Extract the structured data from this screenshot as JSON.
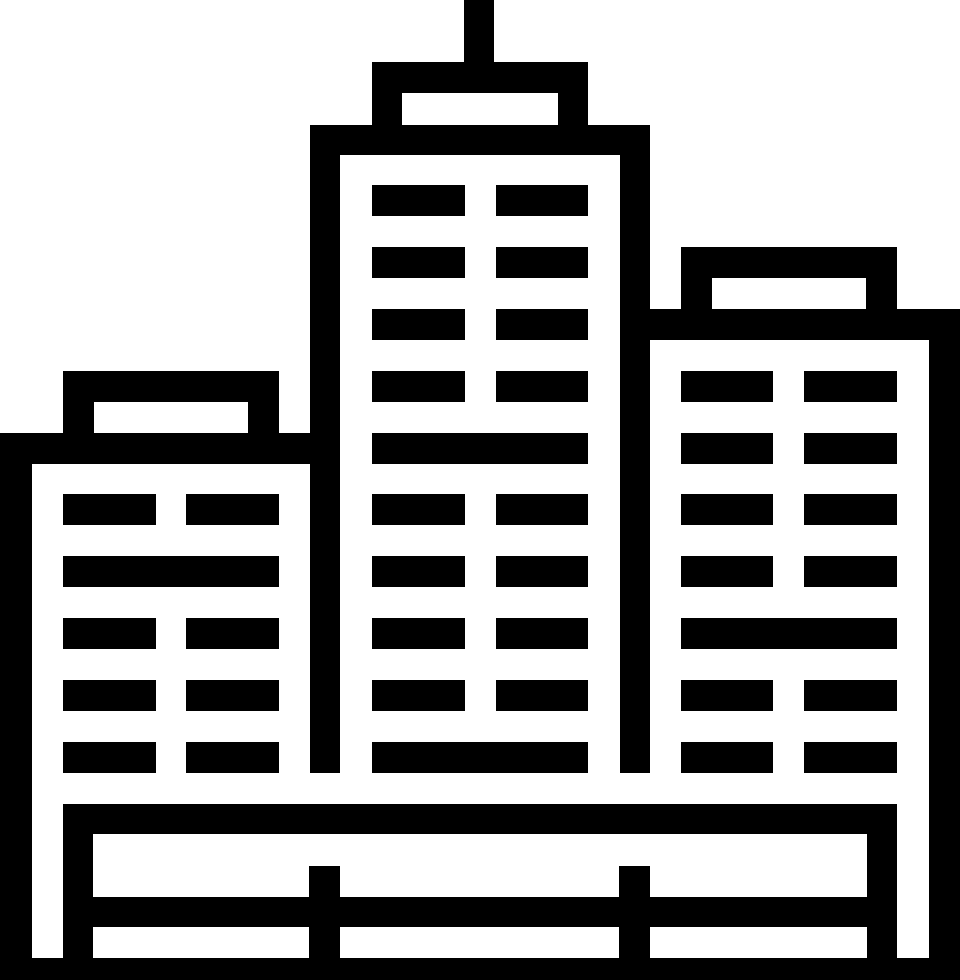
{
  "window": {
    "width": 960,
    "height": 980,
    "background": "#ffffff"
  },
  "icon": {
    "name": "city-buildings-icon",
    "label": "City buildings glyph icon: three skyscrapers with rooftop structures, an antenna, window grids and a fence base",
    "foreground": "#000000",
    "background": "#ffffff",
    "canvas": {
      "width": 960,
      "height": 980
    },
    "groups": [
      {
        "name": "center-building",
        "rects": [
          {
            "name": "antenna",
            "x": 464,
            "y": 0,
            "w": 30,
            "h": 62
          },
          {
            "name": "penthouse-roof",
            "x": 372,
            "y": 62,
            "w": 216,
            "h": 31
          },
          {
            "name": "penthouse-left-wall",
            "x": 372,
            "y": 93,
            "w": 30,
            "h": 32
          },
          {
            "name": "penthouse-right-wall",
            "x": 558,
            "y": 93,
            "w": 30,
            "h": 32
          },
          {
            "name": "top-bar",
            "x": 310,
            "y": 125,
            "w": 340,
            "h": 30
          },
          {
            "name": "left-wall",
            "x": 310,
            "y": 155,
            "w": 30,
            "h": 618
          },
          {
            "name": "right-wall",
            "x": 620,
            "y": 155,
            "w": 30,
            "h": 618
          },
          {
            "name": "window",
            "x": 372,
            "y": 185,
            "w": 93,
            "h": 31
          },
          {
            "name": "window",
            "x": 496,
            "y": 185,
            "w": 92,
            "h": 31
          },
          {
            "name": "window",
            "x": 372,
            "y": 247,
            "w": 93,
            "h": 31
          },
          {
            "name": "window",
            "x": 496,
            "y": 247,
            "w": 92,
            "h": 31
          },
          {
            "name": "window",
            "x": 372,
            "y": 309,
            "w": 93,
            "h": 31
          },
          {
            "name": "window",
            "x": 496,
            "y": 309,
            "w": 92,
            "h": 31
          },
          {
            "name": "window",
            "x": 372,
            "y": 371,
            "w": 93,
            "h": 31
          },
          {
            "name": "window",
            "x": 496,
            "y": 371,
            "w": 92,
            "h": 31
          },
          {
            "name": "window-band",
            "x": 372,
            "y": 433,
            "w": 216,
            "h": 31
          },
          {
            "name": "window",
            "x": 372,
            "y": 494,
            "w": 93,
            "h": 31
          },
          {
            "name": "window",
            "x": 496,
            "y": 494,
            "w": 92,
            "h": 31
          },
          {
            "name": "window",
            "x": 372,
            "y": 556,
            "w": 93,
            "h": 31
          },
          {
            "name": "window",
            "x": 496,
            "y": 556,
            "w": 92,
            "h": 31
          },
          {
            "name": "window",
            "x": 372,
            "y": 618,
            "w": 93,
            "h": 31
          },
          {
            "name": "window",
            "x": 496,
            "y": 618,
            "w": 92,
            "h": 31
          },
          {
            "name": "window",
            "x": 372,
            "y": 680,
            "w": 93,
            "h": 31
          },
          {
            "name": "window",
            "x": 496,
            "y": 680,
            "w": 92,
            "h": 31
          },
          {
            "name": "window-band",
            "x": 372,
            "y": 742,
            "w": 216,
            "h": 31
          }
        ]
      },
      {
        "name": "left-building",
        "rects": [
          {
            "name": "side-wall",
            "x": 0,
            "y": 433,
            "w": 32,
            "h": 525
          },
          {
            "name": "top-bar",
            "x": 0,
            "y": 433,
            "w": 310,
            "h": 31
          },
          {
            "name": "penthouse-roof",
            "x": 63,
            "y": 371,
            "w": 216,
            "h": 31
          },
          {
            "name": "penthouse-left-wall",
            "x": 63,
            "y": 402,
            "w": 31,
            "h": 31
          },
          {
            "name": "penthouse-right-wall",
            "x": 248,
            "y": 402,
            "w": 31,
            "h": 31
          },
          {
            "name": "window",
            "x": 63,
            "y": 494,
            "w": 93,
            "h": 31
          },
          {
            "name": "window",
            "x": 186,
            "y": 494,
            "w": 93,
            "h": 31
          },
          {
            "name": "window-band",
            "x": 63,
            "y": 556,
            "w": 216,
            "h": 31
          },
          {
            "name": "window",
            "x": 63,
            "y": 618,
            "w": 93,
            "h": 31
          },
          {
            "name": "window",
            "x": 186,
            "y": 618,
            "w": 93,
            "h": 31
          },
          {
            "name": "window",
            "x": 63,
            "y": 680,
            "w": 93,
            "h": 31
          },
          {
            "name": "window",
            "x": 186,
            "y": 680,
            "w": 93,
            "h": 31
          },
          {
            "name": "window",
            "x": 63,
            "y": 742,
            "w": 93,
            "h": 31
          },
          {
            "name": "window",
            "x": 186,
            "y": 742,
            "w": 93,
            "h": 31
          }
        ]
      },
      {
        "name": "right-building",
        "rects": [
          {
            "name": "penthouse-roof",
            "x": 681,
            "y": 247,
            "w": 216,
            "h": 31
          },
          {
            "name": "penthouse-left-wall",
            "x": 681,
            "y": 278,
            "w": 31,
            "h": 31
          },
          {
            "name": "penthouse-right-wall",
            "x": 866,
            "y": 278,
            "w": 31,
            "h": 31
          },
          {
            "name": "top-bar",
            "x": 620,
            "y": 309,
            "w": 340,
            "h": 31
          },
          {
            "name": "side-wall",
            "x": 929,
            "y": 340,
            "w": 31,
            "h": 618
          },
          {
            "name": "window",
            "x": 681,
            "y": 371,
            "w": 92,
            "h": 31
          },
          {
            "name": "window",
            "x": 804,
            "y": 371,
            "w": 93,
            "h": 31
          },
          {
            "name": "window",
            "x": 681,
            "y": 433,
            "w": 92,
            "h": 31
          },
          {
            "name": "window",
            "x": 804,
            "y": 433,
            "w": 93,
            "h": 31
          },
          {
            "name": "window",
            "x": 681,
            "y": 494,
            "w": 92,
            "h": 31
          },
          {
            "name": "window",
            "x": 804,
            "y": 494,
            "w": 93,
            "h": 31
          },
          {
            "name": "window",
            "x": 681,
            "y": 556,
            "w": 92,
            "h": 31
          },
          {
            "name": "window",
            "x": 804,
            "y": 556,
            "w": 93,
            "h": 31
          },
          {
            "name": "window-band",
            "x": 681,
            "y": 618,
            "w": 216,
            "h": 31
          },
          {
            "name": "window",
            "x": 681,
            "y": 680,
            "w": 92,
            "h": 31
          },
          {
            "name": "window",
            "x": 804,
            "y": 680,
            "w": 93,
            "h": 31
          },
          {
            "name": "window",
            "x": 681,
            "y": 742,
            "w": 92,
            "h": 31
          },
          {
            "name": "window",
            "x": 804,
            "y": 742,
            "w": 93,
            "h": 31
          }
        ]
      },
      {
        "name": "base-fence",
        "rects": [
          {
            "name": "top-rail",
            "x": 63,
            "y": 804,
            "w": 834,
            "h": 30
          },
          {
            "name": "middle-rail",
            "x": 63,
            "y": 897,
            "w": 834,
            "h": 30
          },
          {
            "name": "ground-bar",
            "x": 0,
            "y": 958,
            "w": 960,
            "h": 22
          },
          {
            "name": "left-post",
            "x": 63,
            "y": 804,
            "w": 30,
            "h": 176
          },
          {
            "name": "mid-left-post",
            "x": 309,
            "y": 866,
            "w": 31,
            "h": 114
          },
          {
            "name": "mid-right-post",
            "x": 619,
            "y": 866,
            "w": 31,
            "h": 114
          },
          {
            "name": "right-post",
            "x": 867,
            "y": 804,
            "w": 30,
            "h": 176
          }
        ]
      }
    ]
  }
}
